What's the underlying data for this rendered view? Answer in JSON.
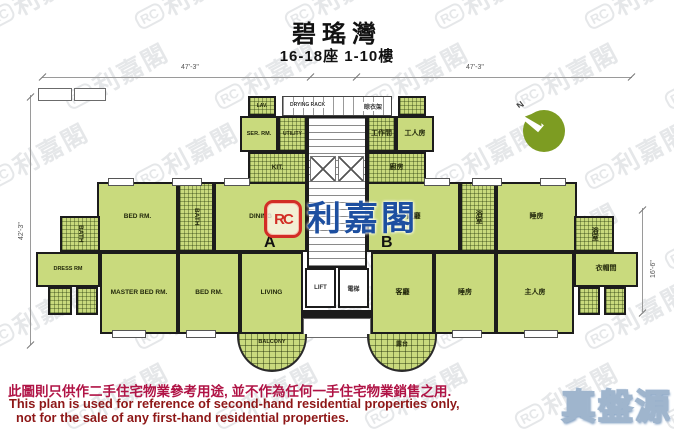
{
  "header": {
    "title": "碧瑤灣",
    "subtitle": "16-18座 1-10樓"
  },
  "dimensions": {
    "top_left": "47'-3\"",
    "top_right": "47'-3\"",
    "left": "42'-3\"",
    "right": "16'-6\""
  },
  "compass": {
    "north": "N"
  },
  "watermark": {
    "logo": "RC",
    "text": "利嘉閣"
  },
  "center_logo": {
    "monogram": "RC",
    "text": "利嘉閣"
  },
  "core": {
    "drying_rack_en": "DRYING RACK",
    "drying_rack_zh": "晾衣架",
    "lift_en": "LIFT",
    "lift_zh": "電梯"
  },
  "unit_a": {
    "label": "A",
    "rooms": {
      "lav": "LAV.",
      "ser_rm": "SER. RM.",
      "utility": "UTILITY",
      "kitchen": "KIT.",
      "dining": "DINING",
      "bed1": "BED RM.",
      "bath1": "BATH",
      "bath2": "BATH",
      "dress": "DRESS RM",
      "master": "MASTER BED RM.",
      "bed2": "BED RM.",
      "living": "LIVING",
      "balcony": "BALCONY"
    }
  },
  "unit_b": {
    "label": "B",
    "rooms": {
      "work": "工作間",
      "servant": "工人房",
      "kitchen": "廚房",
      "dining": "飯廳",
      "bath1": "浴室",
      "bed1": "睡房",
      "living": "客廳",
      "bed2": "睡房",
      "master": "主人房",
      "bath2": "浴室",
      "dress": "衣帽間",
      "balcony": "露台"
    }
  },
  "disclaimer": {
    "zh": "此圖則只供作二手住宅物業參考用途, 並不作為任何一手住宅物業銷售之用.",
    "en_line1": "This plan is used for reference of second-hand residential properties only,",
    "en_line2": "not for the sale of any first-hand residential properties."
  },
  "brand": {
    "badge": "真盤源"
  },
  "colors": {
    "room_green": "#c9da7d",
    "wall_black": "#1c1c1c",
    "disclaimer_zh_red": "#b01345",
    "disclaimer_en_red": "#8e1717",
    "logo_red": "#d22d26",
    "logo_blue": "#1d4fa0",
    "compass_green": "#7d9c22"
  }
}
